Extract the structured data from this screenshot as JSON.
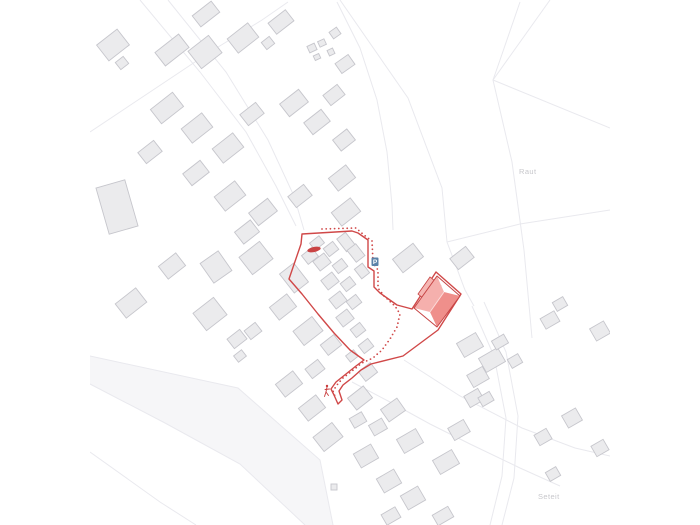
{
  "page": {
    "background": "#ffffff",
    "kind": "architectural site plan map"
  },
  "map": {
    "viewport": {
      "x": 90,
      "w": 520,
      "h": 525
    },
    "colors": {
      "accent": "#d04848",
      "accent_dark": "#c64444",
      "road_line": "#e9e9ee",
      "road_band": "#f6f6f8",
      "building_fill": "#ebebed",
      "building_stroke": "#c6c6cc",
      "label": "#c7c7cb",
      "parking_blue": "#5b82a8",
      "roof_light": "#f5b0ad",
      "roof_dark": "#ef8f8b",
      "roof_wing": "#f6b6b3",
      "ridge_light": "#fcdcda"
    },
    "labels": [
      {
        "text": "Raut",
        "x": 519,
        "y": 174
      },
      {
        "text": "Seteit",
        "x": 538,
        "y": 499
      }
    ],
    "icons": [
      {
        "name": "bus-stop-marker",
        "type": "ellipse",
        "x": 314,
        "y": 249.5,
        "rx": 6.8,
        "ry": 2.6,
        "rot": -12,
        "color": "#c94343"
      },
      {
        "name": "parking-icon",
        "type": "badge",
        "label": "P",
        "x": 371.5,
        "y": 257.5,
        "w": 7,
        "h": 8.5,
        "bg": "#5b82a8",
        "fg": "#ffffff"
      },
      {
        "name": "pedestrian-icon",
        "type": "person",
        "x": 327,
        "y": 387,
        "color": "#c93d3d"
      }
    ],
    "band": [
      [
        90,
        356
      ],
      [
        238,
        388
      ],
      [
        320,
        460
      ],
      [
        333,
        525
      ],
      [
        305,
        525
      ],
      [
        240,
        464
      ],
      [
        165,
        423
      ],
      [
        90,
        384
      ]
    ],
    "road_lines": [
      [
        [
          140,
          0
        ],
        [
          200,
          72
        ],
        [
          246,
          132
        ],
        [
          276,
          186
        ],
        [
          296,
          226
        ]
      ],
      [
        [
          168,
          0
        ],
        [
          226,
          72
        ],
        [
          268,
          140
        ],
        [
          294,
          196
        ],
        [
          304,
          230
        ]
      ],
      [
        [
          90,
          132
        ],
        [
          150,
          92
        ],
        [
          210,
          52
        ],
        [
          262,
          20
        ],
        [
          288,
          2
        ]
      ],
      [
        [
          337,
          2
        ],
        [
          360,
          48
        ],
        [
          377,
          100
        ],
        [
          387,
          152
        ],
        [
          392,
          205
        ],
        [
          393,
          230
        ]
      ],
      [
        [
          340,
          0
        ],
        [
          408,
          98
        ],
        [
          442,
          188
        ],
        [
          447,
          242
        ]
      ],
      [
        [
          520,
          2
        ],
        [
          500,
          60
        ],
        [
          493,
          80
        ]
      ],
      [
        [
          493,
          80
        ],
        [
          610,
          128
        ]
      ],
      [
        [
          493,
          80
        ],
        [
          550,
          0
        ]
      ],
      [
        [
          493,
          80
        ],
        [
          512,
          162
        ],
        [
          524,
          250
        ],
        [
          532,
          338
        ]
      ],
      [
        [
          447,
          242
        ],
        [
          520,
          224
        ],
        [
          610,
          210
        ]
      ],
      [
        [
          447,
          242
        ],
        [
          465,
          290
        ],
        [
          474,
          306
        ]
      ],
      [
        [
          90,
          356
        ],
        [
          238,
          388
        ],
        [
          320,
          460
        ],
        [
          333,
          525
        ]
      ],
      [
        [
          90,
          384
        ],
        [
          165,
          423
        ],
        [
          240,
          464
        ],
        [
          305,
          525
        ]
      ],
      [
        [
          472,
          306
        ],
        [
          494,
          356
        ],
        [
          506,
          418
        ],
        [
          502,
          476
        ],
        [
          490,
          525
        ]
      ],
      [
        [
          484,
          302
        ],
        [
          506,
          352
        ],
        [
          518,
          416
        ],
        [
          514,
          478
        ],
        [
          502,
          525
        ]
      ],
      [
        [
          404,
          360
        ],
        [
          460,
          396
        ],
        [
          522,
          428
        ],
        [
          575,
          448
        ],
        [
          610,
          456
        ]
      ],
      [
        [
          352,
          382
        ],
        [
          390,
          402
        ],
        [
          430,
          424
        ],
        [
          470,
          444
        ],
        [
          520,
          468
        ],
        [
          560,
          486
        ]
      ],
      [
        [
          90,
          452
        ],
        [
          160,
          502
        ],
        [
          196,
          525
        ]
      ]
    ],
    "buildings": [
      [
        113,
        45,
        26,
        20,
        -38
      ],
      [
        122,
        63,
        10,
        9,
        -38
      ],
      [
        172,
        50,
        30,
        17,
        -38
      ],
      [
        205,
        52,
        26,
        22,
        -38
      ],
      [
        206,
        14,
        24,
        14,
        -38
      ],
      [
        243,
        38,
        26,
        18,
        -38
      ],
      [
        281,
        22,
        22,
        14,
        -38
      ],
      [
        268,
        43,
        10,
        9,
        -38
      ],
      [
        312,
        48,
        8,
        7,
        -25
      ],
      [
        322,
        43,
        7,
        6,
        -25
      ],
      [
        331,
        52,
        6,
        6,
        -25
      ],
      [
        317,
        57,
        6,
        5,
        -25
      ],
      [
        345,
        64,
        16,
        12,
        -35
      ],
      [
        335,
        33,
        9,
        8,
        -35
      ],
      [
        167,
        108,
        28,
        18,
        -38
      ],
      [
        197,
        128,
        26,
        18,
        -38
      ],
      [
        228,
        148,
        26,
        18,
        -38
      ],
      [
        252,
        114,
        20,
        14,
        -38
      ],
      [
        294,
        103,
        24,
        16,
        -38
      ],
      [
        317,
        122,
        22,
        15,
        -38
      ],
      [
        334,
        95,
        18,
        13,
        -38
      ],
      [
        344,
        140,
        18,
        14,
        -38
      ],
      [
        150,
        152,
        20,
        14,
        -38
      ],
      [
        196,
        173,
        22,
        15,
        -38
      ],
      [
        117,
        207,
        30,
        48,
        -16
      ],
      [
        230,
        196,
        26,
        18,
        -38
      ],
      [
        263,
        212,
        24,
        16,
        -38
      ],
      [
        300,
        196,
        20,
        14,
        -38
      ],
      [
        342,
        178,
        22,
        16,
        -38
      ],
      [
        247,
        232,
        20,
        15,
        -38
      ],
      [
        172,
        266,
        22,
        16,
        -38
      ],
      [
        216,
        267,
        22,
        24,
        -35
      ],
      [
        131,
        303,
        26,
        18,
        -38
      ],
      [
        210,
        314,
        26,
        22,
        -38
      ],
      [
        237,
        339,
        16,
        12,
        -38
      ],
      [
        256,
        258,
        26,
        22,
        -38
      ],
      [
        294,
        278,
        18,
        24,
        -38
      ],
      [
        310,
        256,
        13,
        11,
        -38
      ],
      [
        283,
        307,
        22,
        16,
        -38
      ],
      [
        308,
        331,
        24,
        18,
        -38
      ],
      [
        253,
        331,
        14,
        11,
        -38
      ],
      [
        317,
        243,
        12,
        9,
        -38
      ],
      [
        331,
        249,
        12,
        10,
        -38
      ],
      [
        346,
        242,
        11,
        16,
        -38
      ],
      [
        322,
        262,
        14,
        12,
        -38
      ],
      [
        340,
        266,
        12,
        10,
        -38
      ],
      [
        356,
        253,
        11,
        15,
        -38
      ],
      [
        330,
        281,
        14,
        12,
        -38
      ],
      [
        348,
        284,
        12,
        10,
        -38
      ],
      [
        362,
        271,
        10,
        12,
        -38
      ],
      [
        338,
        300,
        14,
        12,
        -38
      ],
      [
        354,
        302,
        12,
        10,
        -38
      ],
      [
        345,
        318,
        14,
        12,
        -38
      ],
      [
        358,
        330,
        12,
        10,
        -38
      ],
      [
        331,
        345,
        17,
        13,
        -38
      ],
      [
        366,
        346,
        12,
        10,
        -38
      ],
      [
        352,
        356,
        10,
        8,
        -38
      ],
      [
        408,
        258,
        26,
        17,
        -38
      ],
      [
        462,
        258,
        20,
        14,
        -38
      ],
      [
        346,
        212,
        24,
        17,
        -38
      ],
      [
        289,
        384,
        22,
        16,
        -38
      ],
      [
        315,
        369,
        16,
        12,
        -38
      ],
      [
        312,
        408,
        22,
        16,
        -38
      ],
      [
        328,
        437,
        24,
        18,
        -38
      ],
      [
        360,
        398,
        20,
        15,
        -38
      ],
      [
        368,
        372,
        15,
        12,
        -38
      ],
      [
        358,
        420,
        14,
        11,
        -30
      ],
      [
        378,
        427,
        15,
        12,
        -30
      ],
      [
        393,
        410,
        20,
        15,
        -35
      ],
      [
        410,
        441,
        22,
        16,
        -30
      ],
      [
        366,
        456,
        20,
        16,
        -30
      ],
      [
        389,
        481,
        20,
        16,
        -30
      ],
      [
        413,
        498,
        20,
        16,
        -30
      ],
      [
        446,
        462,
        22,
        16,
        -30
      ],
      [
        459,
        430,
        18,
        14,
        -30
      ],
      [
        474,
        398,
        16,
        13,
        -30
      ],
      [
        443,
        516,
        18,
        12,
        -30
      ],
      [
        391,
        516,
        16,
        12,
        -30
      ],
      [
        334,
        487,
        6,
        6,
        0
      ],
      [
        240,
        356,
        10,
        8,
        -38
      ],
      [
        470,
        345,
        22,
        16,
        -30
      ],
      [
        492,
        360,
        22,
        16,
        -30
      ],
      [
        478,
        377,
        18,
        14,
        -30
      ],
      [
        500,
        342,
        14,
        10,
        -30
      ],
      [
        515,
        361,
        12,
        10,
        -30
      ],
      [
        486,
        399,
        13,
        10,
        -30
      ],
      [
        550,
        320,
        16,
        12,
        -30
      ],
      [
        560,
        304,
        12,
        10,
        -30
      ],
      [
        600,
        331,
        16,
        14,
        -30
      ],
      [
        572,
        418,
        16,
        14,
        -30
      ],
      [
        543,
        437,
        14,
        12,
        -30
      ],
      [
        600,
        448,
        14,
        12,
        -30
      ],
      [
        553,
        474,
        12,
        10,
        -30
      ]
    ],
    "boundary": [
      [
        302,
        234
      ],
      [
        352,
        231
      ],
      [
        358,
        233
      ],
      [
        368,
        240
      ],
      [
        368,
        267
      ],
      [
        374,
        271
      ],
      [
        374,
        287
      ],
      [
        380,
        293
      ],
      [
        397,
        305
      ],
      [
        412,
        309
      ],
      [
        436,
        272
      ],
      [
        461,
        294
      ],
      [
        438,
        330
      ],
      [
        403,
        356
      ],
      [
        371,
        364
      ],
      [
        361,
        370
      ],
      [
        352,
        378
      ],
      [
        343,
        385
      ],
      [
        339,
        391
      ],
      [
        342,
        400
      ],
      [
        338,
        404
      ],
      [
        334,
        395
      ],
      [
        331,
        389
      ],
      [
        336,
        382
      ],
      [
        346,
        374
      ],
      [
        356,
        366
      ],
      [
        364,
        360
      ],
      [
        350,
        350
      ],
      [
        334,
        333
      ],
      [
        318,
        314
      ],
      [
        302,
        294
      ],
      [
        289,
        279
      ],
      [
        301,
        244
      ]
    ],
    "route": [
      [
        322,
        229
      ],
      [
        356,
        228
      ],
      [
        364,
        235
      ],
      [
        372,
        241
      ],
      [
        373,
        263
      ],
      [
        378,
        270
      ],
      [
        378,
        288
      ],
      [
        384,
        296
      ],
      [
        395,
        306
      ],
      [
        400,
        314
      ],
      [
        397,
        327
      ],
      [
        390,
        339
      ],
      [
        382,
        350
      ],
      [
        373,
        358
      ],
      [
        362,
        363
      ],
      [
        352,
        371
      ],
      [
        343,
        378
      ],
      [
        337,
        385
      ],
      [
        333,
        391
      ],
      [
        336,
        399
      ]
    ],
    "red_building": {
      "wing": [
        [
          418,
          294
        ],
        [
          430,
          277
        ],
        [
          441,
          286
        ],
        [
          429,
          303
        ]
      ],
      "plane_upper": [
        [
          414,
          308
        ],
        [
          437,
          276
        ],
        [
          444,
          292
        ],
        [
          430,
          312
        ]
      ],
      "plane_lower": [
        [
          430,
          312
        ],
        [
          444,
          292
        ],
        [
          460,
          296
        ],
        [
          437,
          327
        ]
      ],
      "outline": [
        [
          414,
          308
        ],
        [
          437,
          276
        ],
        [
          460,
          296
        ],
        [
          437,
          327
        ]
      ],
      "ridge": [
        [
          430,
          312
        ],
        [
          444,
          292
        ]
      ]
    }
  }
}
